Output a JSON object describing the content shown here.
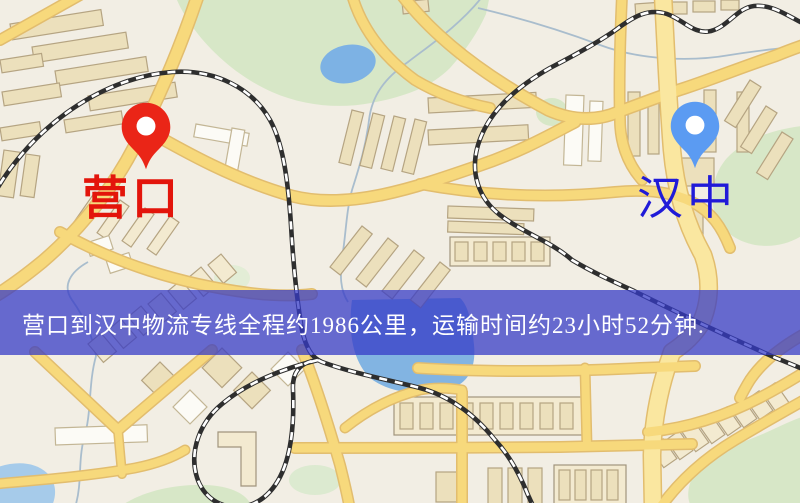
{
  "map": {
    "origin": {
      "label": "营口",
      "pin_color": "#ea2517",
      "pin_inner_color": "#ffffff",
      "label_color": "#e3150b"
    },
    "destination": {
      "label": "汉中",
      "pin_color": "#5b9bf2",
      "pin_inner_color": "#ffffff",
      "label_color": "#201ad8"
    },
    "info_banner": {
      "text": "营口到汉中物流专线全程约1986公里，运输时间约23小时52分钟.",
      "distance_km": "1986",
      "duration": "23小时52分钟",
      "text_color": "#ffffff",
      "overlay_color": "rgba(53,58,199,0.74)"
    },
    "style_colors": {
      "land": "#f2eee4",
      "road_fill": "#f7d97c",
      "road_casing": "#e2bd6e",
      "highway_fill": "#fae7a0",
      "park": "#d7e7c7",
      "water": "#7db2e4",
      "building": "#ece0bc",
      "building_stroke": "#b5a482",
      "railway_dark": "#2e2e2e"
    }
  }
}
